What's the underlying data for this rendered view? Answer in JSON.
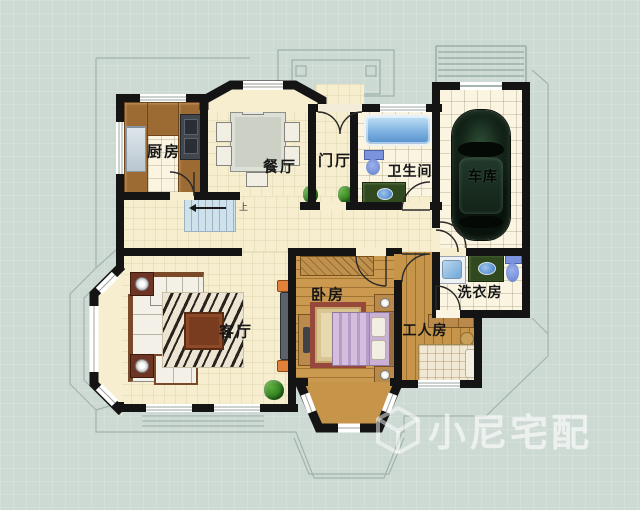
{
  "rooms": {
    "kitchen": {
      "label": "厨房"
    },
    "dining": {
      "label": "餐厅"
    },
    "foyer": {
      "label": "门厅"
    },
    "bathroom": {
      "label": "卫生间"
    },
    "garage": {
      "label": "车库"
    },
    "laundry": {
      "label": "洗衣房"
    },
    "living": {
      "label": "客厅"
    },
    "bedroom": {
      "label": "卧房"
    },
    "workers_room": {
      "label": "工人房"
    }
  },
  "stairs": {
    "up_label": "上"
  },
  "watermark": {
    "brand": "小尼宅配"
  },
  "colors": {
    "background": "#cdd9d3",
    "floor_cream": "#f6eecf",
    "floor_tile": "#faf4e1",
    "floor_wood": "#cb9a50",
    "wall": "#141414",
    "counter_brown": "#9c6a33",
    "water_blue": "#5e9ad2",
    "stairs_blue": "#cfe1ea",
    "plant_green": "#2e7d1e",
    "accent_orange": "#e2813a",
    "watermark_white": "rgba(255,255,255,0.5)"
  }
}
